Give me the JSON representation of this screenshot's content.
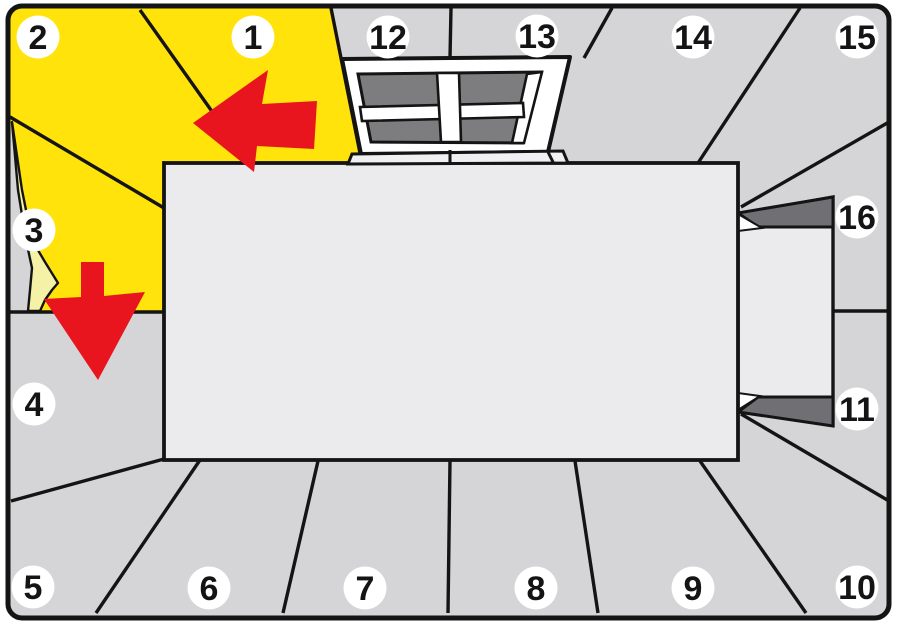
{
  "diagram": {
    "canvas": {
      "width": 897,
      "height": 625
    },
    "colors": {
      "margin": "#ffffff",
      "wall": "#d5d5d7",
      "floor": "#ebebed",
      "yellow": "#ffe30a",
      "pale_back": "#f5f1a6",
      "glass": "#7d7d80",
      "reveal": "#707074",
      "red": "#e8141e",
      "line": "#141414",
      "badge_bg": "#ffffff",
      "badge_text": "#141414"
    },
    "frame": {
      "x": 8,
      "y": 6,
      "width": 881,
      "height": 612,
      "radius": 14,
      "stroke_width": 5
    },
    "regions": {
      "yellow_area": {
        "name": "wallpapered-area",
        "points": "10,8 331,8 362,163 164,163 164,312 10,312"
      },
      "peel_gap": {
        "name": "wall-behind-peel",
        "points": "10,118 18,190 26,240 32,268 30,290 27,311 10,311"
      },
      "peel_curl": {
        "name": "peeled-corner",
        "points": "12,122 18,190 26,240 32,268 30,290 28,311 40,311 45,300 52,290 58,283 45,262 32,240 22,190"
      }
    },
    "seams": [
      {
        "name": "seam-1-2",
        "x1": 140,
        "y1": 10,
        "x2": 250,
        "y2": 165
      },
      {
        "name": "seam-2-3",
        "x1": 10,
        "y1": 117,
        "x2": 164,
        "y2": 208
      },
      {
        "name": "seam-3-4",
        "x1": 10,
        "y1": 312,
        "x2": 164,
        "y2": 312
      },
      {
        "name": "seam-4-5",
        "x1": 164,
        "y1": 459,
        "x2": 11,
        "y2": 501
      },
      {
        "name": "seam-5-6",
        "x1": 200,
        "y1": 460,
        "x2": 96,
        "y2": 613
      },
      {
        "name": "seam-6-7",
        "x1": 318,
        "y1": 461,
        "x2": 283,
        "y2": 613
      },
      {
        "name": "seam-7-8",
        "x1": 450,
        "y1": 460,
        "x2": 448,
        "y2": 613
      },
      {
        "name": "seam-8-9",
        "x1": 575,
        "y1": 461,
        "x2": 598,
        "y2": 613
      },
      {
        "name": "seam-9-10",
        "x1": 700,
        "y1": 461,
        "x2": 806,
        "y2": 613
      },
      {
        "name": "seam-10-11",
        "x1": 741,
        "y1": 414,
        "x2": 889,
        "y2": 501
      },
      {
        "name": "seam-11-16",
        "x1": 833,
        "y1": 311,
        "x2": 890,
        "y2": 311
      },
      {
        "name": "seam-15-16",
        "x1": 889,
        "y1": 122,
        "x2": 741,
        "y2": 207
      },
      {
        "name": "seam-14-15",
        "x1": 800,
        "y1": 8,
        "x2": 698,
        "y2": 163
      },
      {
        "name": "seam-13-14",
        "x1": 612,
        "y1": 8,
        "x2": 584,
        "y2": 58
      },
      {
        "name": "seam-12-13",
        "x1": 451,
        "y1": 8,
        "x2": 450,
        "y2": 58
      },
      {
        "name": "seam-1-12",
        "x1": 331,
        "y1": 8,
        "x2": 362,
        "y2": 163
      }
    ],
    "seams_over": [
      {
        "name": "seam-12-13-lower",
        "x1": 450,
        "y1": 150,
        "x2": 450,
        "y2": 164
      },
      {
        "name": "seam-13-14-lower",
        "x1": 548,
        "y1": 152,
        "x2": 554,
        "y2": 164
      }
    ],
    "floor": {
      "name": "floor",
      "x": 164,
      "y": 163,
      "width": 574,
      "height": 297
    },
    "door": {
      "passage": {
        "name": "door-passage",
        "points": "738,214 833,197 833,425 738,411"
      },
      "top_reveal": {
        "name": "door-reveal-top",
        "points": "738,213 833,197 833,227 758,227"
      },
      "top_edge_white": {
        "name": "door-edge-top",
        "points": "738,214 762,228 738,231"
      },
      "bottom_reveal": {
        "name": "door-reveal-bottom",
        "points": "738,412 758,397 833,397 833,426"
      },
      "bottom_edge_white": {
        "name": "door-edge-bottom",
        "points": "738,410 760,396 738,393"
      }
    },
    "window": {
      "frame": {
        "name": "window-frame",
        "points": "342,59 570,57 548,152 361,154"
      },
      "sill": {
        "name": "window-sill",
        "points": "352,154 563,151 568,163 348,164"
      },
      "glass": {
        "name": "window-glass",
        "points": "358,74 541,72 523,143 371,142"
      },
      "jamb": {
        "name": "window-jamb-right",
        "points": "527,74 542,72 524,143 512,143"
      },
      "mullion_h": {
        "name": "window-mullion-horizontal",
        "points": "360,107 523,103 524,117 362,121"
      },
      "mullion_v": {
        "name": "window-mullion-vertical",
        "points": "437,73 459,73 461,142 441,142"
      }
    },
    "arrows": [
      {
        "name": "arrow-left",
        "points": "193,123 268,70 262,104 317,101 314,149 257,146 254,172"
      },
      {
        "name": "arrow-down",
        "points": "81,262 104,262 104,296 145,292 98,380 44,299 81,297"
      }
    ],
    "badges": [
      {
        "label": "1",
        "x": 253,
        "y": 37
      },
      {
        "label": "2",
        "x": 38,
        "y": 37
      },
      {
        "label": "3",
        "x": 34,
        "y": 230
      },
      {
        "label": "4",
        "x": 34,
        "y": 404
      },
      {
        "label": "5",
        "x": 33,
        "y": 587
      },
      {
        "label": "6",
        "x": 209,
        "y": 588
      },
      {
        "label": "7",
        "x": 365,
        "y": 588
      },
      {
        "label": "8",
        "x": 536,
        "y": 588
      },
      {
        "label": "9",
        "x": 693,
        "y": 588
      },
      {
        "label": "10",
        "x": 857,
        "y": 587
      },
      {
        "label": "11",
        "x": 857,
        "y": 409
      },
      {
        "label": "12",
        "x": 388,
        "y": 37
      },
      {
        "label": "13",
        "x": 537,
        "y": 36
      },
      {
        "label": "14",
        "x": 693,
        "y": 37
      },
      {
        "label": "15",
        "x": 857,
        "y": 37
      },
      {
        "label": "16",
        "x": 857,
        "y": 217
      }
    ],
    "badge_radius": 21.5
  }
}
